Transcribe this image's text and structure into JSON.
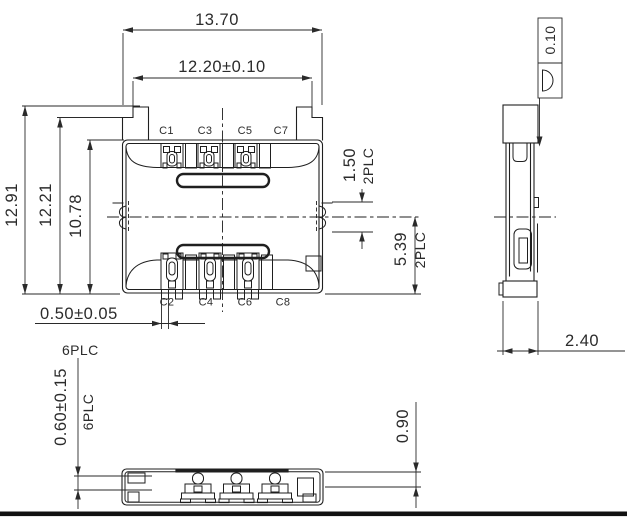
{
  "dims": {
    "overall_width": "13.70",
    "body_width": "12.20±0.10",
    "overall_depth": "12.91",
    "mid_depth": "12.21",
    "body_depth": "10.78",
    "terminal_width": "0.50±0.05",
    "terminal_places": "6PLC",
    "standoff_height": "0.60±0.15",
    "standoff_places": "6PLC",
    "notch_offset": "1.50",
    "notch_places": "2PLC",
    "half_depth": "5.39",
    "half_depth_places": "2PLC",
    "side_width": "2.40",
    "lead_height": "0.90",
    "profile_tolerance": "0.10"
  },
  "contacts": {
    "top": [
      "C1",
      "C3",
      "C5",
      "C7"
    ],
    "bottom": [
      "C2",
      "C4",
      "C6",
      "C8"
    ]
  },
  "colors": {
    "line": "#1f1f1f",
    "text": "#2b2b2b",
    "background": "#ffffff"
  }
}
